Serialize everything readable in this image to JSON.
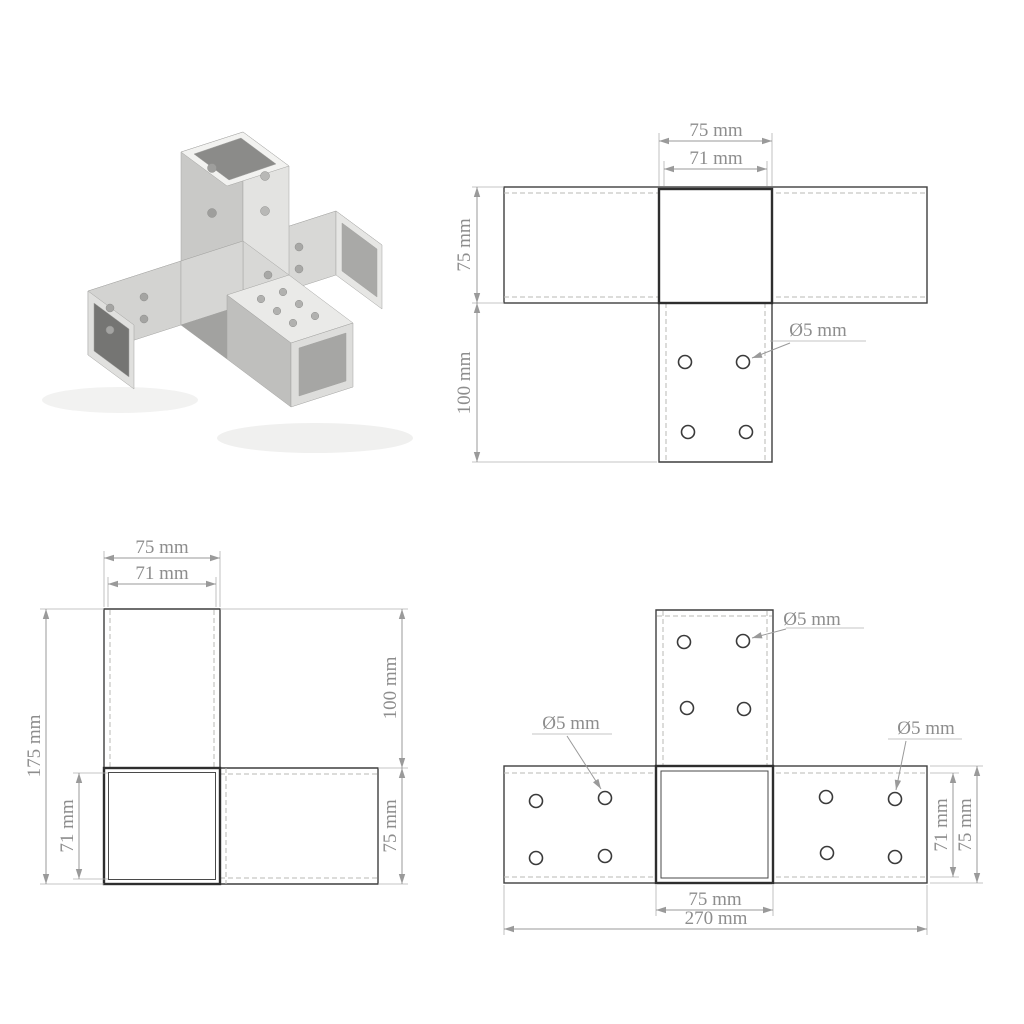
{
  "page": {
    "background": "#ffffff"
  },
  "photo": {
    "description": "galvanized metal X-form post connector, four square sleeves with bolt holes",
    "metal_light": "#f2f2f0",
    "metal_mid": "#d6d6d4",
    "metal_dark": "#8b8b89"
  },
  "style": {
    "dimension_color": "#8d8d8d",
    "outline_color": "#3f3f3f",
    "thick_outline_color": "#2e2e2e",
    "dashed_color": "#b8b8b6"
  },
  "drawings": {
    "top_right": {
      "width_75": "75 mm",
      "width_71": "71 mm",
      "height_75": "75 mm",
      "leg_100": "100 mm",
      "hole": "Ø5 mm"
    },
    "bottom_left": {
      "width_75": "75 mm",
      "width_71": "71 mm",
      "total_175": "175 mm",
      "inner_71": "71 mm",
      "leg_100": "100 mm",
      "side_75": "75 mm"
    },
    "bottom_right": {
      "hole_top": "Ø5 mm",
      "hole_left": "Ø5 mm",
      "hole_right": "Ø5 mm",
      "center_75": "75 mm",
      "total_270": "270 mm",
      "inner_71": "71 mm",
      "side_75": "75 mm"
    }
  }
}
